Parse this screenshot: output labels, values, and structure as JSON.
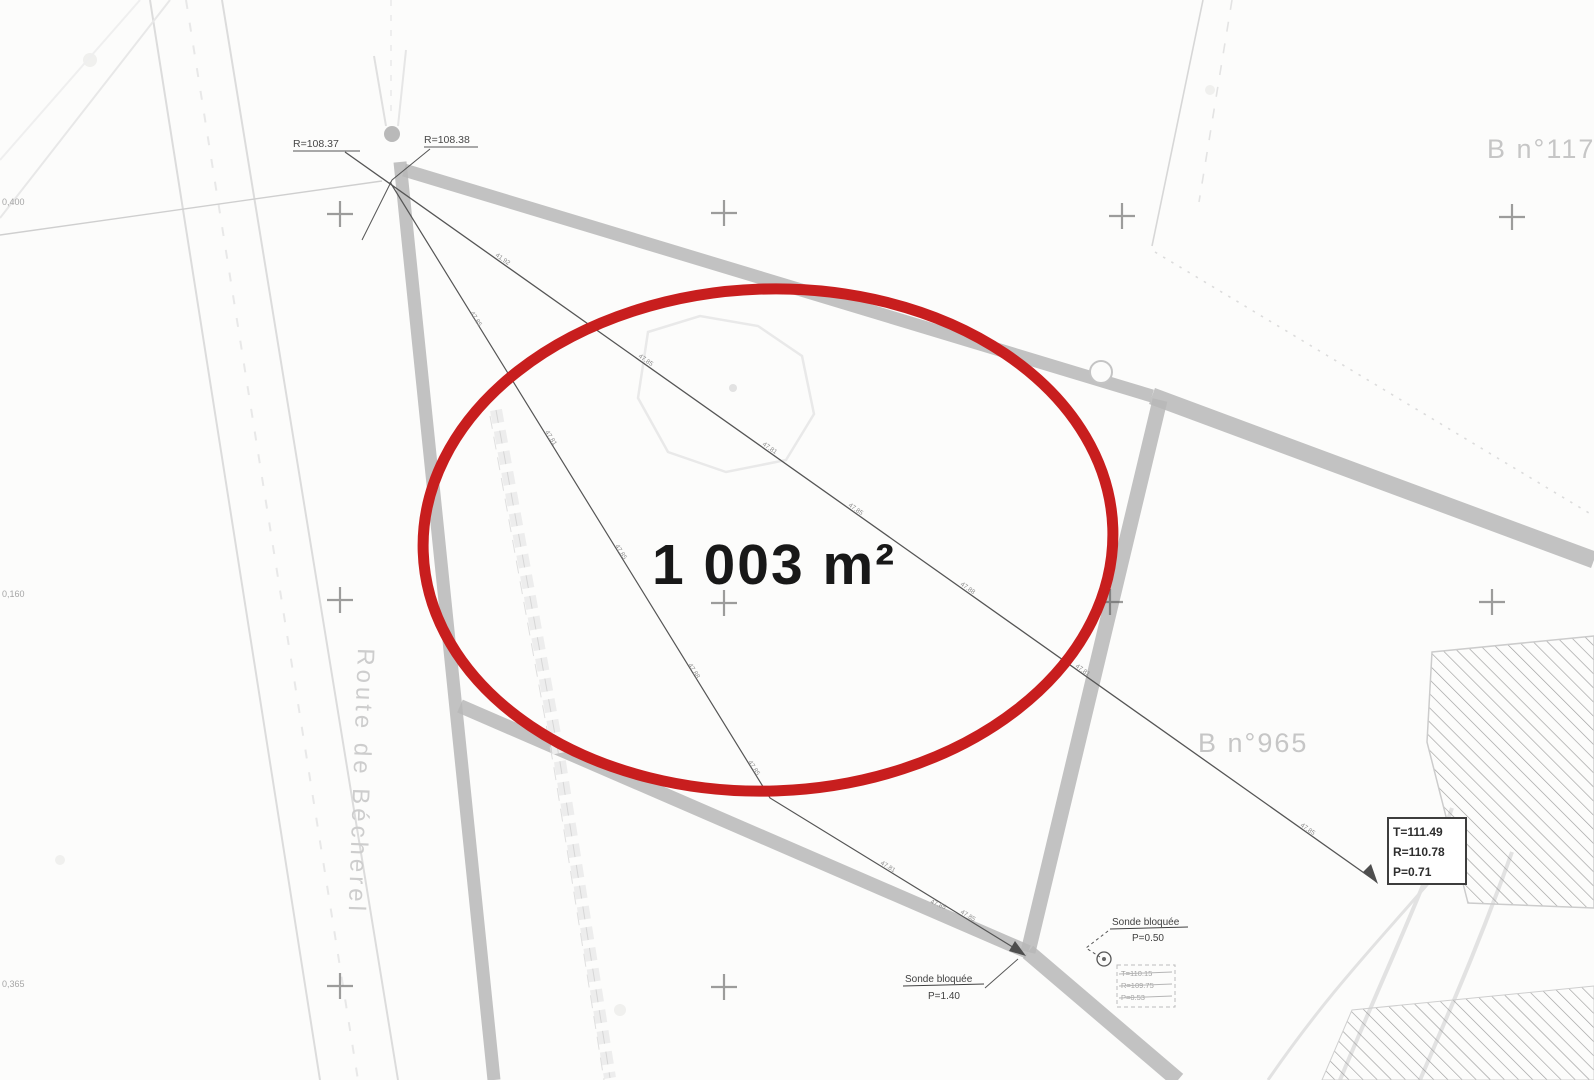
{
  "map": {
    "highlight": {
      "area_label": "1 003 m²",
      "ellipse_color": "#c81e1e"
    },
    "streets": {
      "route_label": "Route de Bécherel"
    },
    "parcels": {
      "parcel_117": "B n°117",
      "parcel_965": "B n°965"
    },
    "survey_points": {
      "radius_left": "R=108.37",
      "radius_right": "R=108.38"
    },
    "measure_box": {
      "line1": "T=111.49",
      "line2": "R=110.78",
      "line3": "P=0.71"
    },
    "sonde_upper": {
      "name": "Sonde bloquée",
      "depth": "P=0.50"
    },
    "sonde_lower": {
      "name": "Sonde bloquée",
      "depth": "P=1.40"
    },
    "faint_box": {
      "line1": "T=110.15",
      "line2": "R=109.75",
      "line3": "P=0.53"
    },
    "edge_coords": [
      "0,400",
      "0,160",
      "0,365"
    ],
    "line_marks": [
      "41.92",
      "47.85",
      "47.81",
      "47.85",
      "47.88",
      "47.81",
      "47.85",
      "47.85",
      "47.81",
      "47.85",
      "47.88",
      "47.85",
      "47.81",
      "47.85",
      "47.85"
    ],
    "colors": {
      "road_gray": "#b7b7b7",
      "survey_line": "#555555",
      "highlight_red": "#c81e1e"
    }
  }
}
